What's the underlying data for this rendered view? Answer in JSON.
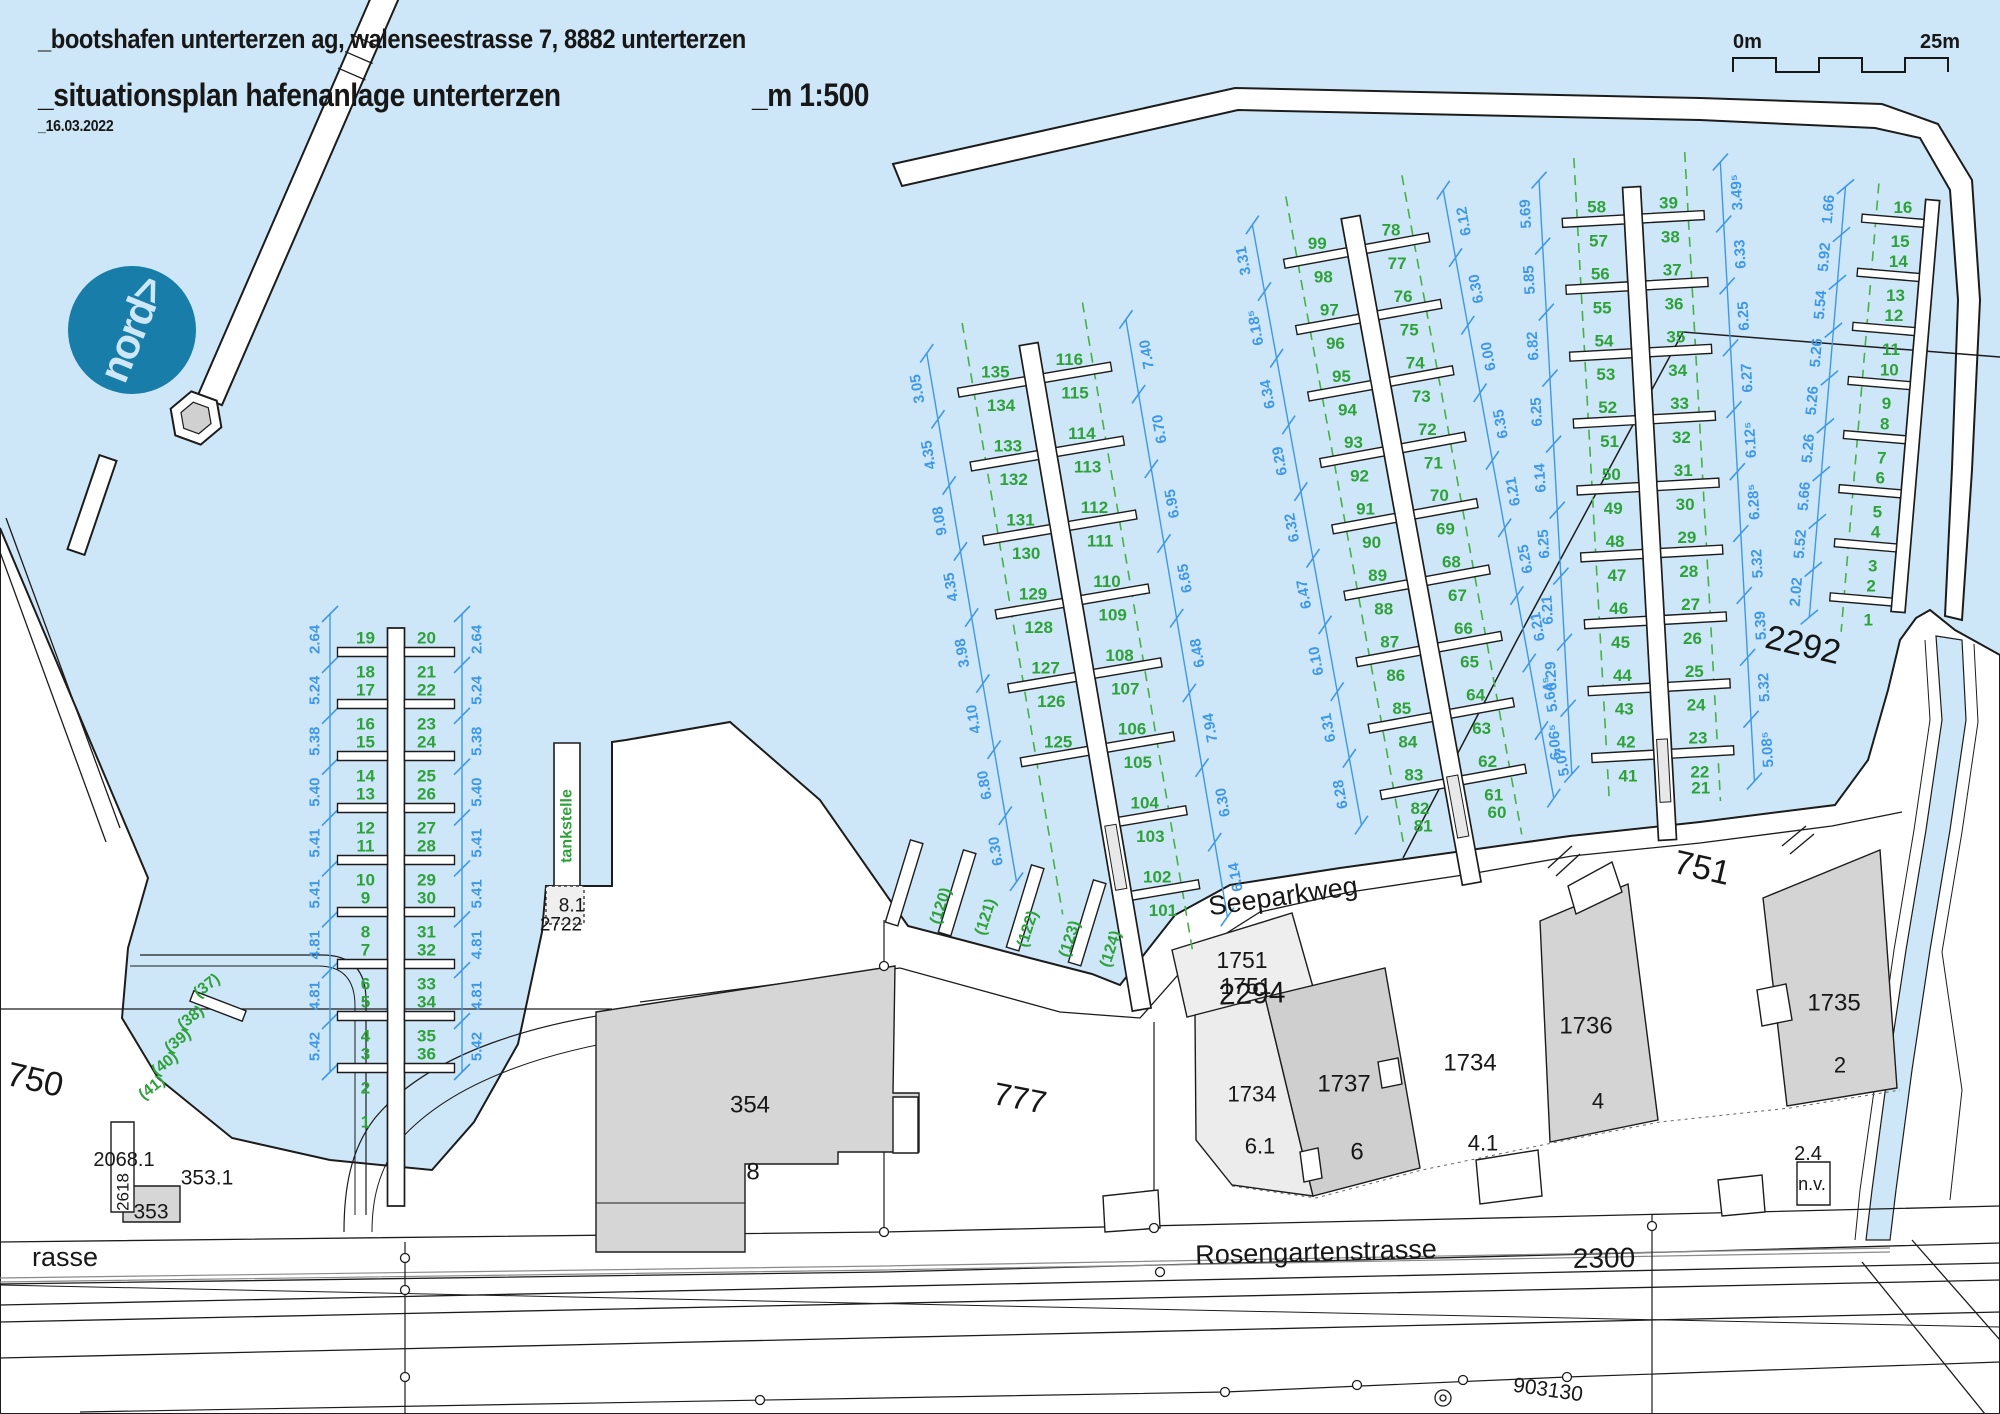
{
  "header": {
    "line1": "_bootshafen unterterzen ag, walenseestrasse 7, 8882 unterterzen",
    "line2": "_situationsplan hafenanlage unterterzen",
    "scale_label": "_m 1:500",
    "date": "_16.03.2022"
  },
  "scale_bar": {
    "start": "0m",
    "end": "25m"
  },
  "north_badge": {
    "text": "nord>"
  },
  "colors": {
    "ink": "#1c1c1c",
    "water": "#cee7f8",
    "green": "#2fa13b",
    "green2": "#46b046",
    "blue": "#3f98e6",
    "teal": "#187da8",
    "bld": "#d6d6d6",
    "bld_dark": "#cfcfcf",
    "bld_light": "#ececec",
    "white": "#ffffff"
  },
  "map": {
    "labels": [
      {
        "t": "750",
        "x": 35,
        "y": 1080,
        "r": 13,
        "s": 34
      },
      {
        "t": "751",
        "x": 1702,
        "y": 868,
        "r": 13,
        "s": 34
      },
      {
        "t": "777",
        "x": 1020,
        "y": 1098,
        "r": 11,
        "s": 32
      },
      {
        "t": "2292",
        "x": 1803,
        "y": 645,
        "r": 13,
        "s": 34
      },
      {
        "t": "2294",
        "x": 1252,
        "y": 994,
        "r": -2,
        "s": 30
      },
      {
        "t": "1751",
        "x": 1242,
        "y": 960,
        "r": 0,
        "s": 23
      },
      {
        "t": "1751",
        "x": 1246,
        "y": 986,
        "r": 0,
        "s": 23
      },
      {
        "t": "2300",
        "x": 1604,
        "y": 1258,
        "r": -1,
        "s": 28
      },
      {
        "t": "Rosengartenstrasse",
        "x": 1316,
        "y": 1252,
        "r": -1.5,
        "s": 27
      },
      {
        "t": "rasse",
        "x": 32,
        "y": 1257,
        "r": 0,
        "s": 27
      },
      {
        "t": "Seeparkweg",
        "x": 1283,
        "y": 896,
        "r": -8,
        "s": 27
      },
      {
        "t": "903130",
        "x": 1548,
        "y": 1390,
        "r": 8,
        "s": 21
      },
      {
        "t": "354",
        "x": 750,
        "y": 1105,
        "r": 0,
        "s": 24
      },
      {
        "t": "8",
        "x": 753,
        "y": 1172,
        "r": 0,
        "s": 24
      },
      {
        "t": "353.1",
        "x": 207,
        "y": 1178,
        "r": 0,
        "s": 21
      },
      {
        "t": "353",
        "x": 151,
        "y": 1212,
        "r": 0,
        "s": 21
      },
      {
        "t": "2068.1",
        "x": 124,
        "y": 1160,
        "r": 0,
        "s": 20
      },
      {
        "t": "2618",
        "x": 123,
        "y": 1192,
        "r": -90,
        "s": 17
      },
      {
        "t": "8.1",
        "x": 572,
        "y": 906,
        "r": 0,
        "s": 19
      },
      {
        "t": "2722",
        "x": 561,
        "y": 925,
        "r": 0,
        "s": 19
      },
      {
        "t": "tankstelle",
        "x": 567,
        "y": 826,
        "r": -90,
        "s": 16,
        "c": "green"
      },
      {
        "t": "1734",
        "x": 1252,
        "y": 1094,
        "r": 0,
        "s": 22
      },
      {
        "t": "6.1",
        "x": 1260,
        "y": 1146,
        "r": 0,
        "s": 22
      },
      {
        "t": "1737",
        "x": 1344,
        "y": 1084,
        "r": 0,
        "s": 24
      },
      {
        "t": "6",
        "x": 1357,
        "y": 1152,
        "r": 0,
        "s": 24
      },
      {
        "t": "1734",
        "x": 1470,
        "y": 1063,
        "r": 0,
        "s": 24
      },
      {
        "t": "4.1",
        "x": 1483,
        "y": 1143,
        "r": 0,
        "s": 22
      },
      {
        "t": "1736",
        "x": 1586,
        "y": 1026,
        "r": 0,
        "s": 24
      },
      {
        "t": "4",
        "x": 1598,
        "y": 1101,
        "r": 0,
        "s": 22
      },
      {
        "t": "1735",
        "x": 1834,
        "y": 1003,
        "r": 0,
        "s": 24
      },
      {
        "t": "2",
        "x": 1840,
        "y": 1065,
        "r": 0,
        "s": 22
      },
      {
        "t": "2.4",
        "x": 1808,
        "y": 1154,
        "r": 0,
        "s": 20
      },
      {
        "t": "n.v.",
        "x": 1812,
        "y": 1184,
        "r": 0,
        "s": 18
      },
      {
        "t": "(37)",
        "x": 207,
        "y": 986,
        "r": -38,
        "s": 16,
        "c": "green"
      },
      {
        "t": "(38)",
        "x": 191,
        "y": 1018,
        "r": -38,
        "s": 16,
        "c": "green"
      },
      {
        "t": "(39)",
        "x": 178,
        "y": 1041,
        "r": -38,
        "s": 16,
        "c": "green"
      },
      {
        "t": "(40)",
        "x": 165,
        "y": 1064,
        "r": -38,
        "s": 16,
        "c": "green"
      },
      {
        "t": "(41)",
        "x": 152,
        "y": 1088,
        "r": -38,
        "s": 16,
        "c": "green"
      },
      {
        "t": "(120)",
        "x": 941,
        "y": 906,
        "r": -72,
        "s": 16,
        "c": "green"
      },
      {
        "t": "(121)",
        "x": 986,
        "y": 917,
        "r": -72,
        "s": 16,
        "c": "green"
      },
      {
        "t": "(122)",
        "x": 1028,
        "y": 929,
        "r": -72,
        "s": 16,
        "c": "green"
      },
      {
        "t": "(123)",
        "x": 1070,
        "y": 939,
        "r": -72,
        "s": 16,
        "c": "green"
      },
      {
        "t": "(124)",
        "x": 1111,
        "y": 949,
        "r": -72,
        "s": 16,
        "c": "green"
      }
    ],
    "piers": [
      {
        "id": "A",
        "p0": [
          396,
          636
        ],
        "p1": [
          396,
          1164
        ],
        "ext": 42,
        "w": 17,
        "f": {
          "count": 9,
          "s0": 16,
          "s1": 432,
          "len": 50,
          "lw": 9
        },
        "label_d": 22,
        "left": [
          [
            "19",
            "18"
          ],
          [
            "17",
            "16"
          ],
          [
            "15",
            "14"
          ],
          [
            "13",
            "12"
          ],
          [
            "11",
            "10"
          ],
          [
            "9",
            "8"
          ],
          [
            "7",
            "6"
          ],
          [
            "5",
            "4"
          ],
          [
            "3",
            "2"
          ]
        ],
        "right": [
          [
            "20",
            "21"
          ],
          [
            "22",
            "23"
          ],
          [
            "24",
            "25"
          ],
          [
            "26",
            "27"
          ],
          [
            "28",
            "29"
          ],
          [
            "30",
            "31"
          ],
          [
            "32",
            "33"
          ],
          [
            "34",
            "35"
          ],
          [
            "36",
            ""
          ]
        ],
        "solo": [
          {
            "t": "1",
            "s": 486,
            "side": 1
          }
        ],
        "chains": [
          {
            "o": 66,
            "s0": -22,
            "s1": 436,
            "vals": [
              "2.64",
              "5.24",
              "5.38",
              "5.40",
              "5.41",
              "5.41",
              "4.81",
              "4.81",
              "5.42"
            ]
          },
          {
            "o": -66,
            "s0": -22,
            "s1": 436,
            "vals": [
              "2.64",
              "5.24",
              "5.38",
              "5.40",
              "5.41",
              "5.41",
              "4.81",
              "4.81",
              "5.42"
            ]
          }
        ],
        "dashed": []
      },
      {
        "id": "B",
        "p0": [
          1030,
          352
        ],
        "p1": [
          1136,
          976
        ],
        "ext": 34,
        "w": 19,
        "f": {
          "count": 8,
          "s0": 28,
          "s1": 553,
          "len": 68,
          "lw": 9
        },
        "label_d": 28,
        "left": [
          [
            "135",
            "134"
          ],
          [
            "133",
            "132"
          ],
          [
            "131",
            "130"
          ],
          [
            "129",
            "128"
          ],
          [
            "127",
            "126"
          ],
          [
            "125",
            ""
          ],
          [
            "",
            ""
          ],
          [
            "",
            ""
          ]
        ],
        "right": [
          [
            "116",
            "115"
          ],
          [
            "114",
            "113"
          ],
          [
            "112",
            "111"
          ],
          [
            "110",
            "109"
          ],
          [
            "108",
            "107"
          ],
          [
            "106",
            "105"
          ],
          [
            "104",
            "103"
          ],
          [
            "102",
            "101"
          ]
        ],
        "solo": [],
        "chains": [
          {
            "o": 102,
            "s0": -16,
            "s1": 520,
            "vals": [
              "3.05",
              "4.35",
              "9.08",
              "4.35",
              "3.98",
              "4.10",
              "6.80",
              "6.30"
            ]
          },
          {
            "o": -100,
            "s0": -16,
            "s1": 590,
            "vals": [
              "7.40",
              "6.70",
              "6.95",
              "6.65",
              "6.48",
              "7.94",
              "6.30",
              "6.14"
            ]
          }
        ],
        "dashed": [
          {
            "o": 62,
            "s0": -40,
            "s1": 560
          },
          {
            "o": -60,
            "s0": -40,
            "s1": 620
          }
        ],
        "box": {
          "s0": 480,
          "s1": 545
        }
      },
      {
        "id": "C",
        "p0": [
          1352,
          225
        ],
        "p1": [
          1466,
          852
        ],
        "ext": 32,
        "w": 19,
        "f": {
          "count": 9,
          "s0": 26,
          "s1": 566,
          "len": 64,
          "lw": 9
        },
        "label_d": 28,
        "left": [
          [
            "99",
            "98"
          ],
          [
            "97",
            "96"
          ],
          [
            "95",
            "94"
          ],
          [
            "93",
            "92"
          ],
          [
            "91",
            "90"
          ],
          [
            "89",
            "88"
          ],
          [
            "87",
            "86"
          ],
          [
            "85",
            "84"
          ],
          [
            "83",
            "82"
          ]
        ],
        "right": [
          [
            "78",
            "77"
          ],
          [
            "76",
            "75"
          ],
          [
            "74",
            "73"
          ],
          [
            "72",
            "71"
          ],
          [
            "70",
            "69"
          ],
          [
            "68",
            "67"
          ],
          [
            "66",
            "65"
          ],
          [
            "64",
            "63"
          ],
          [
            "62",
            "61"
          ]
        ],
        "solo": [
          {
            "t": "81",
            "s": 604,
            "side": 1
          },
          {
            "t": "60",
            "s": 604,
            "side": -1
          }
        ],
        "chains": [
          {
            "o": 98,
            "s0": -18,
            "s1": 592,
            "vals": [
              "3.31",
              "6.18⁵",
              "6.34",
              "6.29",
              "6.32",
              "6.47",
              "6.10",
              "6.31",
              "6.28"
            ]
          },
          {
            "o": -96,
            "s0": -18,
            "s1": 600,
            "vals": [
              "6.12",
              "6.30",
              "6.00",
              "6.35",
              "6.21",
              "6.25",
              "6.21",
              "5.64⁵",
              "5.07"
            ]
          }
        ],
        "dashed": [
          {
            "o": 60,
            "s0": -40,
            "s1": 620
          },
          {
            "o": -58,
            "s0": -40,
            "s1": 630
          }
        ],
        "box": {
          "s0": 560,
          "s1": 622
        }
      },
      {
        "id": "D",
        "p0": [
          1632,
          195
        ],
        "p1": [
          1666,
          812
        ],
        "ext": 28,
        "w": 18,
        "f": {
          "count": 9,
          "s0": 24,
          "s1": 560,
          "len": 62,
          "lw": 9
        },
        "label_d": 27,
        "left": [
          [
            "58",
            "57"
          ],
          [
            "56",
            "55"
          ],
          [
            "54",
            "53"
          ],
          [
            "52",
            "51"
          ],
          [
            "50",
            "49"
          ],
          [
            "48",
            "47"
          ],
          [
            "46",
            "45"
          ],
          [
            "44",
            "43"
          ],
          [
            "42",
            "41"
          ]
        ],
        "right": [
          [
            "39",
            "38"
          ],
          [
            "37",
            "36"
          ],
          [
            "35",
            "34"
          ],
          [
            "33",
            "32"
          ],
          [
            "31",
            "30"
          ],
          [
            "29",
            "28"
          ],
          [
            "27",
            "26"
          ],
          [
            "25",
            "24"
          ],
          [
            "23",
            "22"
          ]
        ],
        "solo": [
          {
            "t": "21",
            "s": 596,
            "side": -1
          }
        ],
        "chains": [
          {
            "o": 92,
            "s0": -20,
            "s1": 575,
            "vals": [
              "5.69",
              "5.85",
              "6.82",
              "6.25",
              "6.14",
              "6.25",
              "6.21",
              "6.29",
              "6.06⁵"
            ]
          },
          {
            "o": -90,
            "s0": -28,
            "s1": 592,
            "vals": [
              "3.49⁵",
              "6.33",
              "6.25",
              "6.27",
              "6.12⁵",
              "6.28⁵",
              "5.32",
              "5.39",
              "5.32",
              "5.08⁵"
            ]
          }
        ],
        "dashed": [
          {
            "o": 56,
            "s0": -40,
            "s1": 600
          },
          {
            "o": -55,
            "s0": -40,
            "s1": 610
          }
        ],
        "box": {
          "s0": 545,
          "s1": 608
        }
      },
      {
        "id": "E",
        "p0": [
          1932,
          208
        ],
        "p1": [
          1898,
          612
        ],
        "ext": 0,
        "w": 14,
        "f": {
          "count": 8,
          "s0": 16,
          "s1": 396,
          "len": 62,
          "lw": 8
        },
        "label_d": 22,
        "left": [
          [
            "16",
            "15"
          ],
          [
            "14",
            "13"
          ],
          [
            "12",
            "11"
          ],
          [
            "10",
            "9"
          ],
          [
            "8",
            "7"
          ],
          [
            "6",
            "5"
          ],
          [
            "4",
            "3"
          ],
          [
            "2",
            "1"
          ]
        ],
        "right": [],
        "solo": [],
        "chains": [
          {
            "o": 88,
            "s0": -14,
            "s1": 418,
            "vals": [
              "1.66",
              "5.92",
              "5.54",
              "5.26",
              "5.26",
              "5.26",
              "5.66",
              "5.52",
              "2.02"
            ]
          }
        ],
        "dashed": [
          {
            "o": 55,
            "s0": -20,
            "s1": 430
          }
        ]
      }
    ],
    "shore_fingers": [
      {
        "x": 905,
        "y": 880,
        "r": 17
      },
      {
        "x": 958,
        "y": 890,
        "r": 17
      },
      {
        "x": 1026,
        "y": 905,
        "r": 17
      },
      {
        "x": 1088,
        "y": 920,
        "r": 17
      }
    ]
  }
}
